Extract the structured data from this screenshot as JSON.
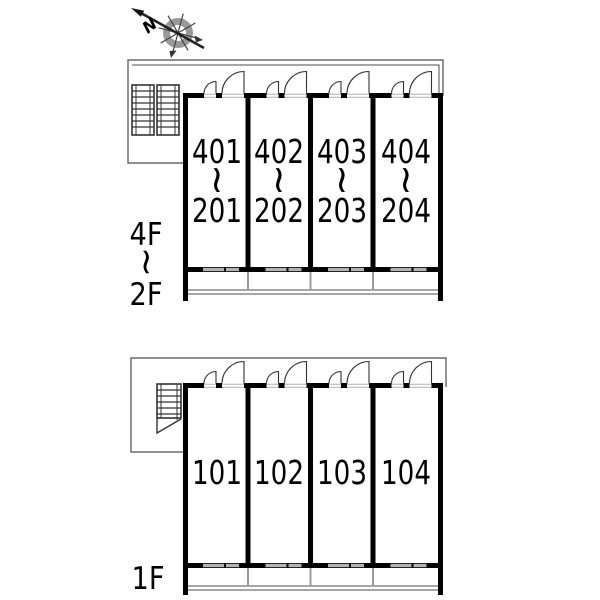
{
  "compass": {
    "north_label": "N"
  },
  "upper_plan": {
    "floor_from": "4F",
    "floor_tilde": "~",
    "floor_to": "2F",
    "units": [
      {
        "top": "401",
        "tilde": "~",
        "bottom": "201"
      },
      {
        "top": "402",
        "tilde": "~",
        "bottom": "202"
      },
      {
        "top": "403",
        "tilde": "~",
        "bottom": "203"
      },
      {
        "top": "404",
        "tilde": "~",
        "bottom": "204"
      }
    ]
  },
  "lower_plan": {
    "floor_label": "1F",
    "units": [
      {
        "number": "101"
      },
      {
        "number": "102"
      },
      {
        "number": "103"
      },
      {
        "number": "104"
      }
    ]
  },
  "colors": {
    "wall": "#000000",
    "thin_outline": "#4d4d4d",
    "window": "#b3b3b3",
    "balcony_partition": "#9a9a9a",
    "compass_ring": "#999999",
    "arrow": "#222222",
    "background": "#ffffff"
  }
}
